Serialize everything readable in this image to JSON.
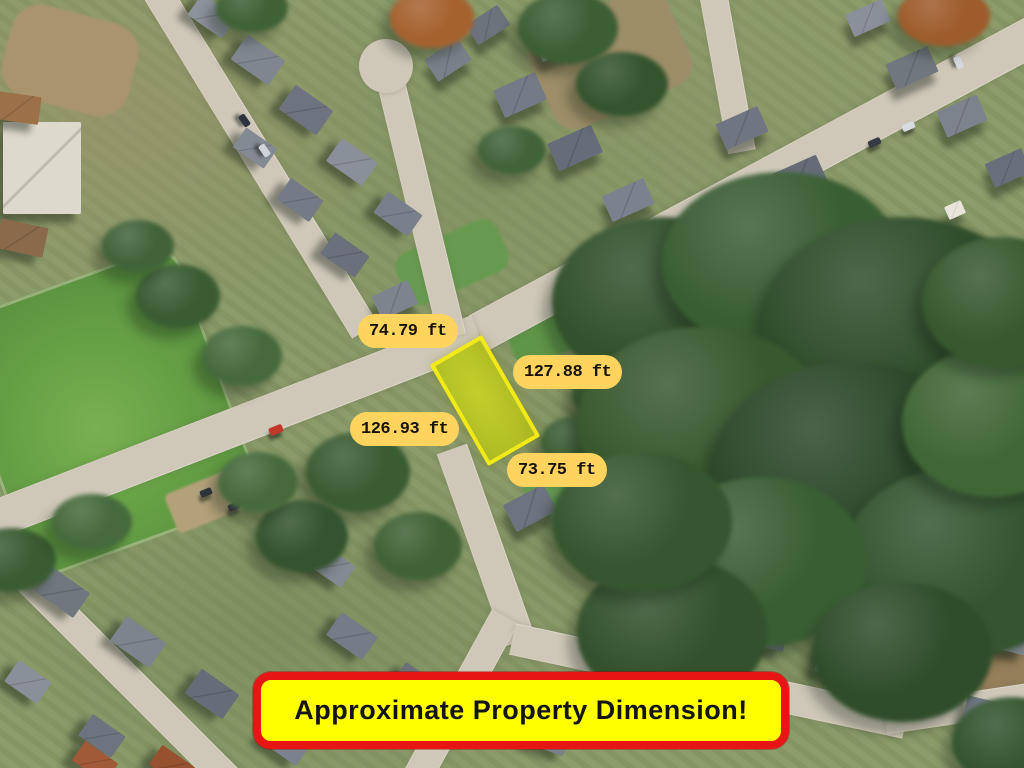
{
  "map": {
    "description": "aerial-satellite-view-of-residential-neighborhood-with-highlighted-vacant-lot",
    "parcel_highlight": {
      "fill": "#b5c226",
      "border": "#f2ea16"
    },
    "labels": {
      "fill": "#ffd45e",
      "text_color": "#161208",
      "items": [
        {
          "id": "top-edge",
          "text": "74.79 ft"
        },
        {
          "id": "right-edge",
          "text": "127.88 ft"
        },
        {
          "id": "left-edge",
          "text": "126.93 ft"
        },
        {
          "id": "bottom-edge",
          "text": "73.75 ft"
        }
      ]
    },
    "banner": {
      "text": "Approximate Property Dimension!",
      "fill": "#ffff00",
      "border": "#e81515",
      "text_color": "#141414"
    }
  }
}
